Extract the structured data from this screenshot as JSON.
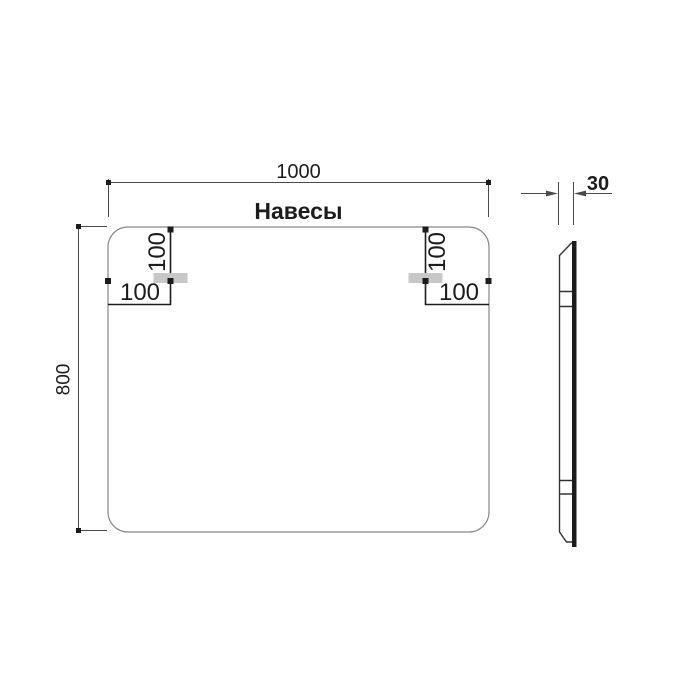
{
  "colors": {
    "background": "#ffffff",
    "panel_outline": "#878787",
    "dimension_line": "#4a4a4a",
    "ink": "#1c1c1c",
    "bracket_fill": "#c7c7c7"
  },
  "drawing": {
    "front_view": {
      "title": "Навесы",
      "width_label": "1000",
      "height_label": "800",
      "left_hanger": {
        "from_top_label": "100",
        "from_edge_label": "100"
      },
      "right_hanger": {
        "from_top_label": "100",
        "from_edge_label": "100"
      }
    },
    "side_view": {
      "thickness_label": "30"
    }
  }
}
